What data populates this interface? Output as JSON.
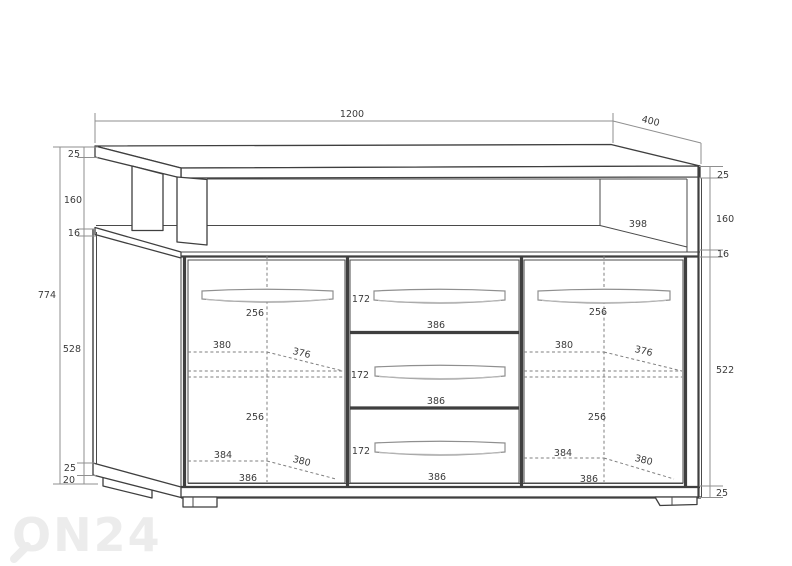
{
  "watermark": {
    "text": "ON24"
  },
  "colors": {
    "line": "#3f3f3f",
    "dim_line": "#8f8f8f",
    "text": "#3b3b3b",
    "watermark": "#ececec",
    "background": "#ffffff"
  },
  "dims": {
    "overall": {
      "width": "1200",
      "depth": "400",
      "height": "774"
    },
    "top": {
      "shelf_opening_width": "398"
    },
    "left_chain": [
      "25",
      "160",
      "16",
      "528",
      "25",
      "20"
    ],
    "right_chain": [
      "25",
      "160",
      "16",
      "522",
      "25"
    ],
    "left_door": {
      "handle_width": "256",
      "shelf_width": "380",
      "shelf_depth": "376",
      "lower_handle_width": "256",
      "bottom_width": "384",
      "bottom_depth": "380",
      "door_width": "386"
    },
    "right_door": {
      "handle_width": "256",
      "shelf_width": "380",
      "shelf_depth": "376",
      "lower_handle_width": "256",
      "bottom_width": "384",
      "bottom_depth": "380",
      "door_width": "386"
    },
    "drawers": [
      {
        "height": "172",
        "width": "386"
      },
      {
        "height": "172",
        "width": "386"
      },
      {
        "height": "172",
        "width": "386"
      }
    ]
  }
}
